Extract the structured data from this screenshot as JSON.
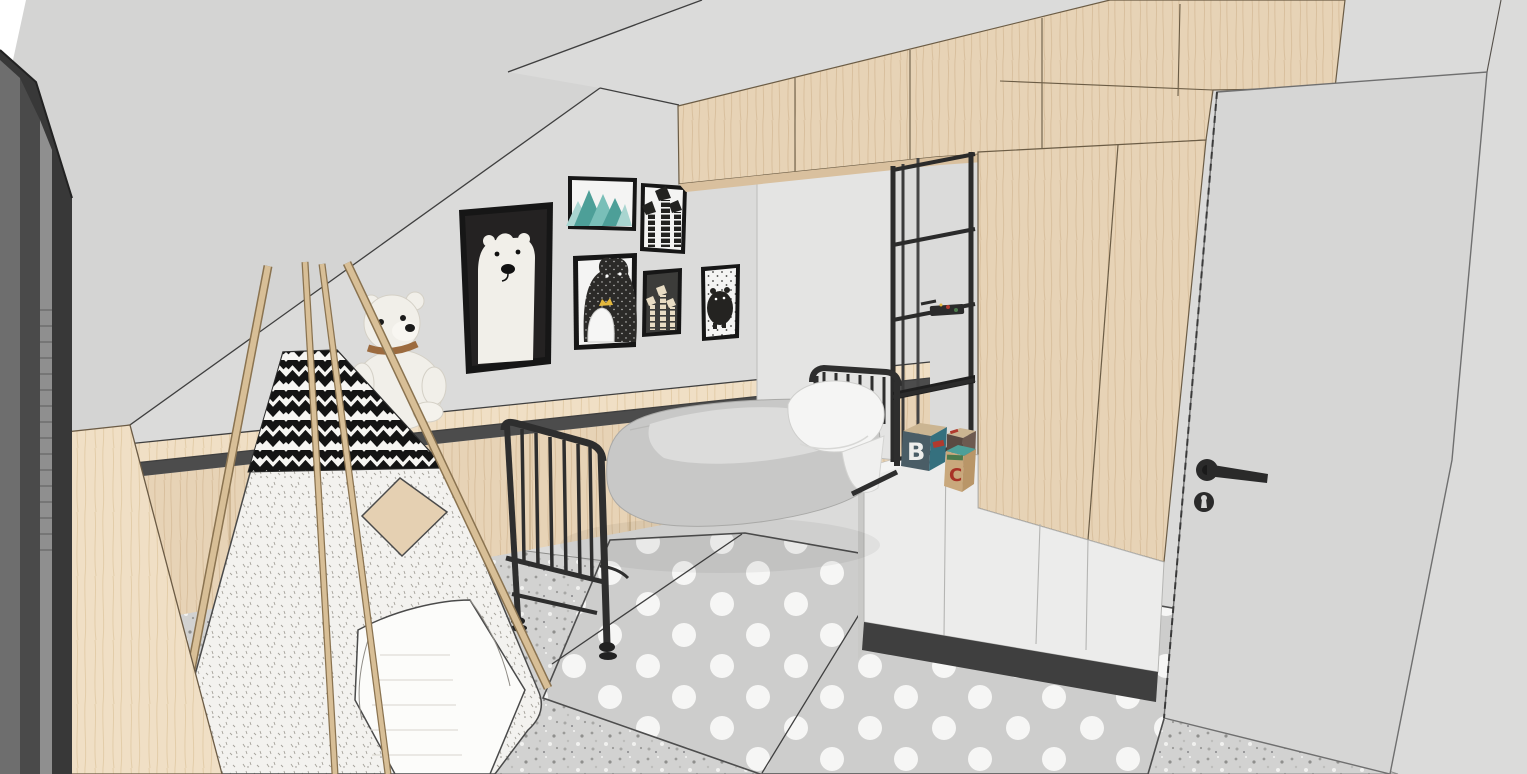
{
  "meta": {
    "description": "3D SketchUp-style rendering of an attic children's bedroom: slanted ceiling, dark roof window at left, wood desk, black-and-white teepee play tent, white teddy bear on a low wood bench, gallery wall with six posters (polar bear, teal mountains, giraffes, black bear with cub, small giraffes on dark, dotted bear), black metal day bed with gray duvet and white pillow, black open shelving with toy blocks, wood upper cabinets and wardrobe with white lower units, polka-dot rug, terrazzo floor and an open gray door with black lever handle."
  },
  "palette": {
    "outside": "#ffffff",
    "wall": "#dbdbda",
    "ceiling": "#d4d4d3",
    "line": "#3f3f3f",
    "wood": "#e7d3b6",
    "wood_light": "#f0dfc5",
    "wood_grain": "#d9c09e",
    "wood_edge": "#8a7350",
    "bench_recess": "#4c4c4c",
    "window_dark": "#383838",
    "window_mid": "#6e6e6e",
    "window_light": "#8f8f8f",
    "floor": "#d2d2d1",
    "floor_speck_dark": "#8f8f8d",
    "rug": "#cdcdcc",
    "rug_dot": "#f6f6f5",
    "door": "#d6d6d5",
    "handle_black": "#2a2a2a",
    "metal_black": "#2e2e2e",
    "mattress": "#c8c8c7",
    "throw_light": "#dcdcdb",
    "pillow": "#f5f5f4",
    "white_unit": "#ececeb",
    "white_unit_top": "#f4f4f3",
    "plinth": "#3f3f3f",
    "panel_white": "#e4e4e3",
    "fabric": "#f3f2ef",
    "fabric_mark": "#a5a29a",
    "chevron_black": "#141414",
    "poster_black": "#242222",
    "poster_white": "#f4f4f3",
    "teal_dark": "#4d9f98",
    "teal_mid": "#79bfb8",
    "teal_light": "#a8d5d0",
    "crown_gold": "#e3b83d",
    "bear_white": "#f1efe9",
    "collar_brown": "#9c6b3f",
    "pole_wood": "#d8bf97"
  },
  "toys": {
    "blocks": [
      {
        "letter": "B",
        "color": "#eeeeec"
      },
      {
        "letter": "W",
        "color": "#f2f2f0"
      },
      {
        "letter": "C",
        "color": "#a83226"
      }
    ]
  }
}
